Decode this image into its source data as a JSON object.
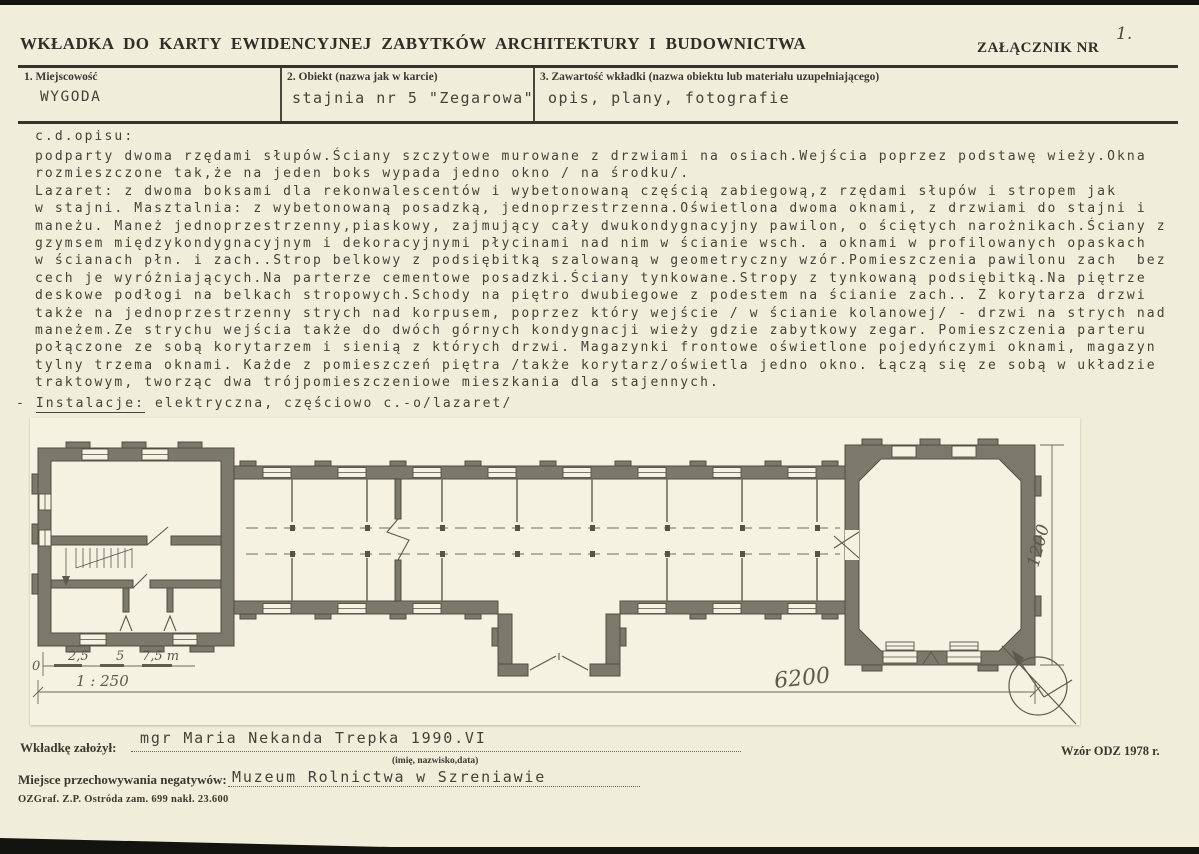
{
  "header": {
    "title": "WKŁADKA DO KARTY EWIDENCYJNEJ ZABYTKÓW ARCHITEKTURY I BUDOWNICTWA",
    "attachment_label": "ZAŁĄCZNIK NR",
    "attachment_number": "1."
  },
  "fields": [
    {
      "label": "1. Miejscowość",
      "value": "WYGODA"
    },
    {
      "label": "2. Obiekt (nazwa jak w karcie)",
      "value": "stajnia nr 5 \"Zegarowa\""
    },
    {
      "label": "3. Zawartość wkładki (nazwa obiektu lub materiału uzupełniającego)",
      "value": "opis, plany, fotografie"
    }
  ],
  "description": {
    "heading": "c.d.opisu:",
    "lines": [
      "podparty dwoma rzędami słupów.Ściany szczytowe murowane z drzwiami na osiach.Wejścia poprzez podstawę wieży.Okna",
      "rozmieszczone tak,że na jeden boks wypada jedno okno / na środku/.",
      "Lazaret: z dwoma boksami dla rekonwalescentów i wybetonowaną częścią zabiegową,z rzędami słupów i stropem jak",
      "w stajni. Masztalnia: z wybetonowaną posadzką, jednoprzestrzenna.Oświetlona dwoma oknami, z drzwiami do stajni i",
      "maneżu. Maneż jednoprzestrzenny,piaskowy, zajmujący cały dwukondygnacyjny pawilon, o ściętych narożnikach.Ściany z",
      "gzymsem międzykondygnacyjnym i dekoracyjnymi płycinami nad nim w ścianie wsch. a oknami w profilowanych opaskach",
      "w ścianach płn. i zach..Strop belkowy z podsiębitką szalowaną w geometryczny wzór.Pomieszczenia pawilonu zach  bez",
      "cech je wyróżniających.Na parterze cementowe posadzki.Ściany tynkowane.Stropy z tynkowaną podsiębitką.Na piętrze",
      "deskowe podłogi na belkach stropowych.Schody na piętro dwubiegowe z podestem na ścianie zach.. Z korytarza drzwi",
      "także na jednoprzestrzenny strych nad korpusem, poprzez który wejście / w ścianie kolanowej/ - drzwi na strych nad",
      "maneżem.Ze strychu wejścia także do dwóch górnych kondygnacji wieży gdzie zabytkowy zegar. Pomieszczenia parteru",
      "połączone ze sobą korytarzem i sienią z których drzwi. Magazynki frontowe oświetlone pojedyńczymi oknami, magazyn",
      "tylny trzema oknami. Każde z pomieszczeń piętra /także korytarz/oświetla jedno okno. Łączą się ze sobą w układzie",
      "traktowym, tworząc dwa trójpomieszczeniowe mieszkania dla stajennych."
    ],
    "installations": {
      "dash": "-",
      "label": "Instalacje:",
      "text": " elektryczna, częściowo c.-o/lazaret/"
    }
  },
  "plan": {
    "scale": {
      "zero": "0",
      "tick1": "2,5",
      "tick2": "5",
      "tick3": "7,5 m",
      "ratio": "1 : 250"
    },
    "dimensions": {
      "length": "6200",
      "width": "1200"
    },
    "north_icon": "compass-north-arrow"
  },
  "footer": {
    "created_by_label": "Wkładkę założył:",
    "created_by_value": "mgr Maria Nekanda Trepka 1990.VI",
    "created_by_hint": "(imię, nazwisko,data)",
    "negatives_label": "Miejsce przechowywania negatywów:",
    "negatives_value": "Muzeum Rolnictwa w Szreniawie",
    "print_info": "OZGraf. Z.P. Ostróda zam. 699 nakł. 23.600",
    "form_version": "Wzór ODZ 1978 r."
  }
}
